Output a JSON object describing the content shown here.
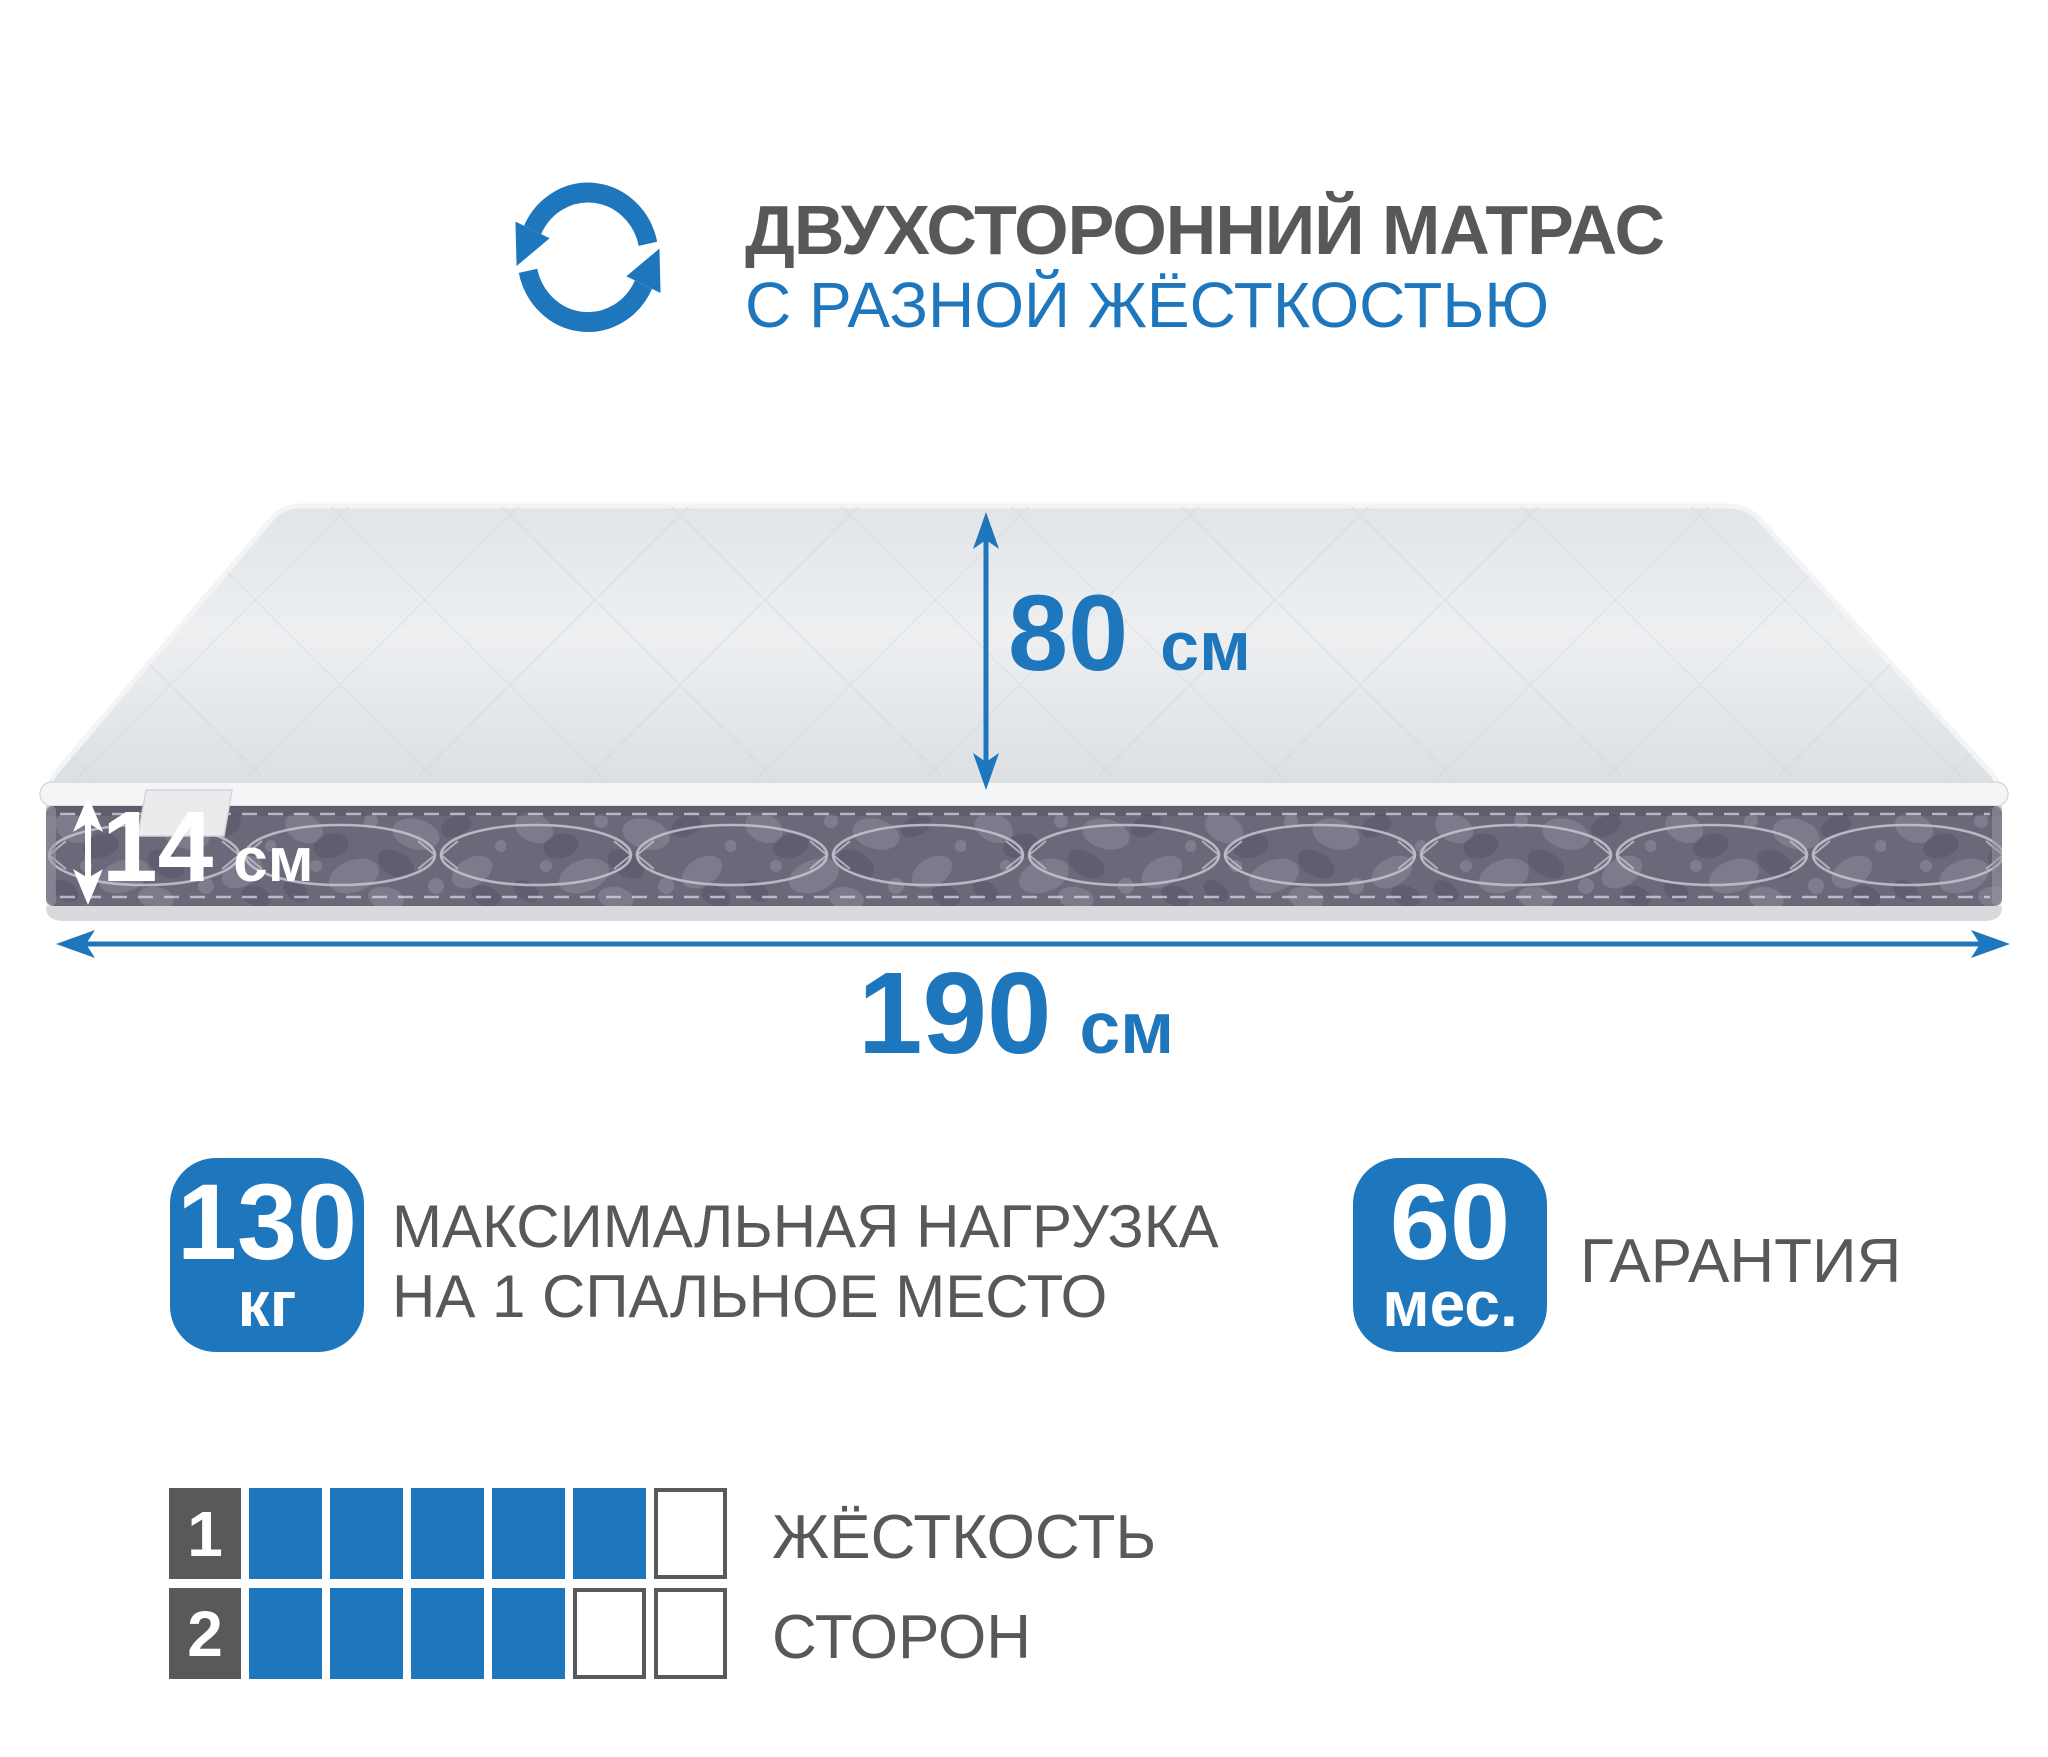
{
  "colors": {
    "accent_blue": "#1e76bc",
    "text_gray": "#57585a",
    "side_fabric_dark": "#615e70",
    "top_fabric_light": "#e7eaec"
  },
  "header": {
    "icon": "rotate-arrows-icon",
    "title": "ДВУХСТОРОННИЙ МАТРАС",
    "subtitle": "С РАЗНОЙ ЖЁСТКОСТЬЮ"
  },
  "dimensions": {
    "depth": {
      "value": "80",
      "unit": "см"
    },
    "height": {
      "value": "14",
      "unit": "см"
    },
    "length": {
      "value": "190",
      "unit": "см"
    }
  },
  "max_load": {
    "value": "130",
    "unit": "кг",
    "label_line1": "МАКСИМАЛЬНАЯ НАГРУЗКА",
    "label_line2": "НА 1 СПАЛЬНОЕ МЕСТО"
  },
  "warranty": {
    "value": "60",
    "unit": "мес.",
    "label": "ГАРАНТИЯ"
  },
  "firmness": {
    "title_line1": "ЖЁСТКОСТЬ",
    "title_line2": "СТОРОН",
    "scale_max": 6,
    "sides": [
      {
        "row": "1",
        "filled": 5
      },
      {
        "row": "2",
        "filled": 4
      }
    ]
  }
}
